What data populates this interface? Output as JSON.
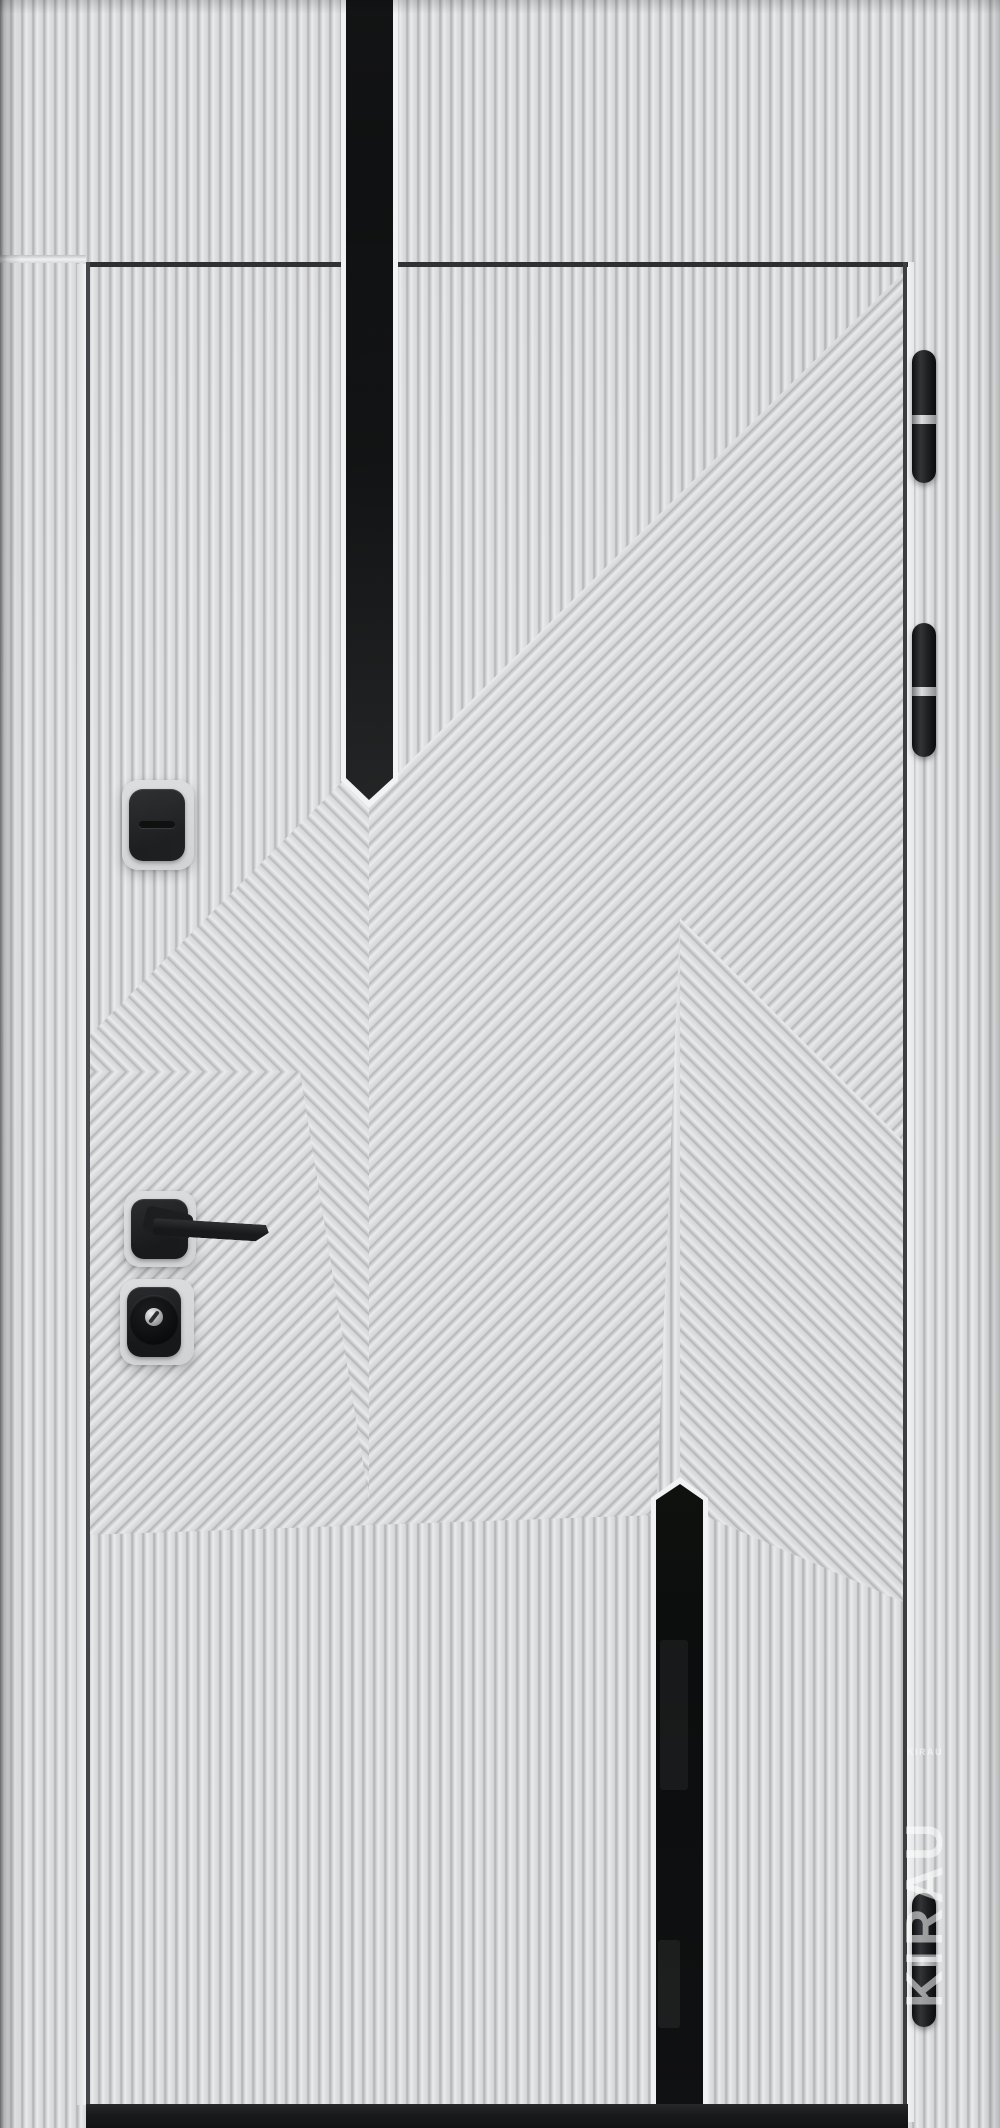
{
  "meta": {
    "type": "product-photo",
    "subject": "modern entry door, light gray fluted panel with chevron milling, two black vertical glass inserts, black hardware"
  },
  "colors": {
    "panel": "#e1e2e3",
    "groove": "#b3b5b7",
    "glass": "#0b0d0e",
    "hardware": "#1b1c1e",
    "silver": "#c9cbcd",
    "plate": "#d7d8d9",
    "threshold": "#191a1b",
    "gap_shadow": "#2e2f31",
    "edge_highlight": "#f3f4f5"
  },
  "door": {
    "glass_inserts": 2,
    "hinge_count": 3,
    "locks": 2,
    "handle": "black lever on square rosette",
    "threshold": "black bottom bar"
  },
  "watermark": {
    "small_text": "KIRAU",
    "big_text": "KIRAU"
  }
}
